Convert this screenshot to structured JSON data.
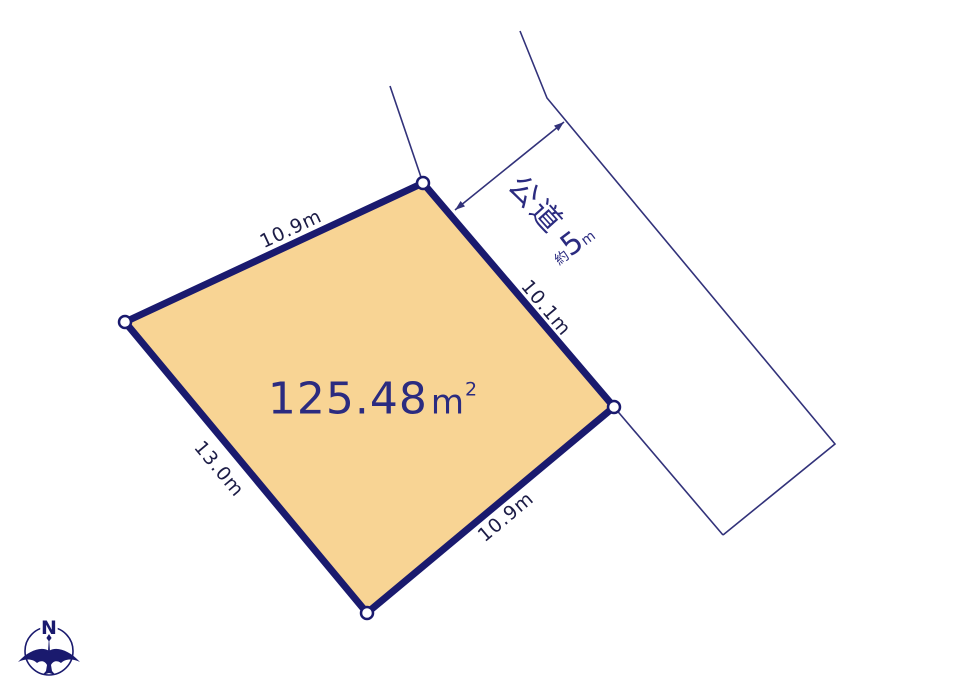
{
  "plot": {
    "area": {
      "value": "125.48",
      "unit": "m",
      "exponent": "2"
    },
    "edge_labels": {
      "top": "10.9m",
      "left": "13.0m",
      "bottom": "10.9m",
      "right": "10.1m"
    }
  },
  "road": {
    "name": "公道",
    "width": {
      "prefix": "約",
      "value": "5",
      "unit": "m"
    }
  },
  "compass": {
    "north": "N"
  },
  "colors": {
    "background": "#ffffff",
    "plot_fill": "#f8d494",
    "plot_border": "#1a1a6e",
    "thin_line": "#32327a",
    "dimension_text": "#1c1c46",
    "accent_text": "#2b2b80"
  }
}
